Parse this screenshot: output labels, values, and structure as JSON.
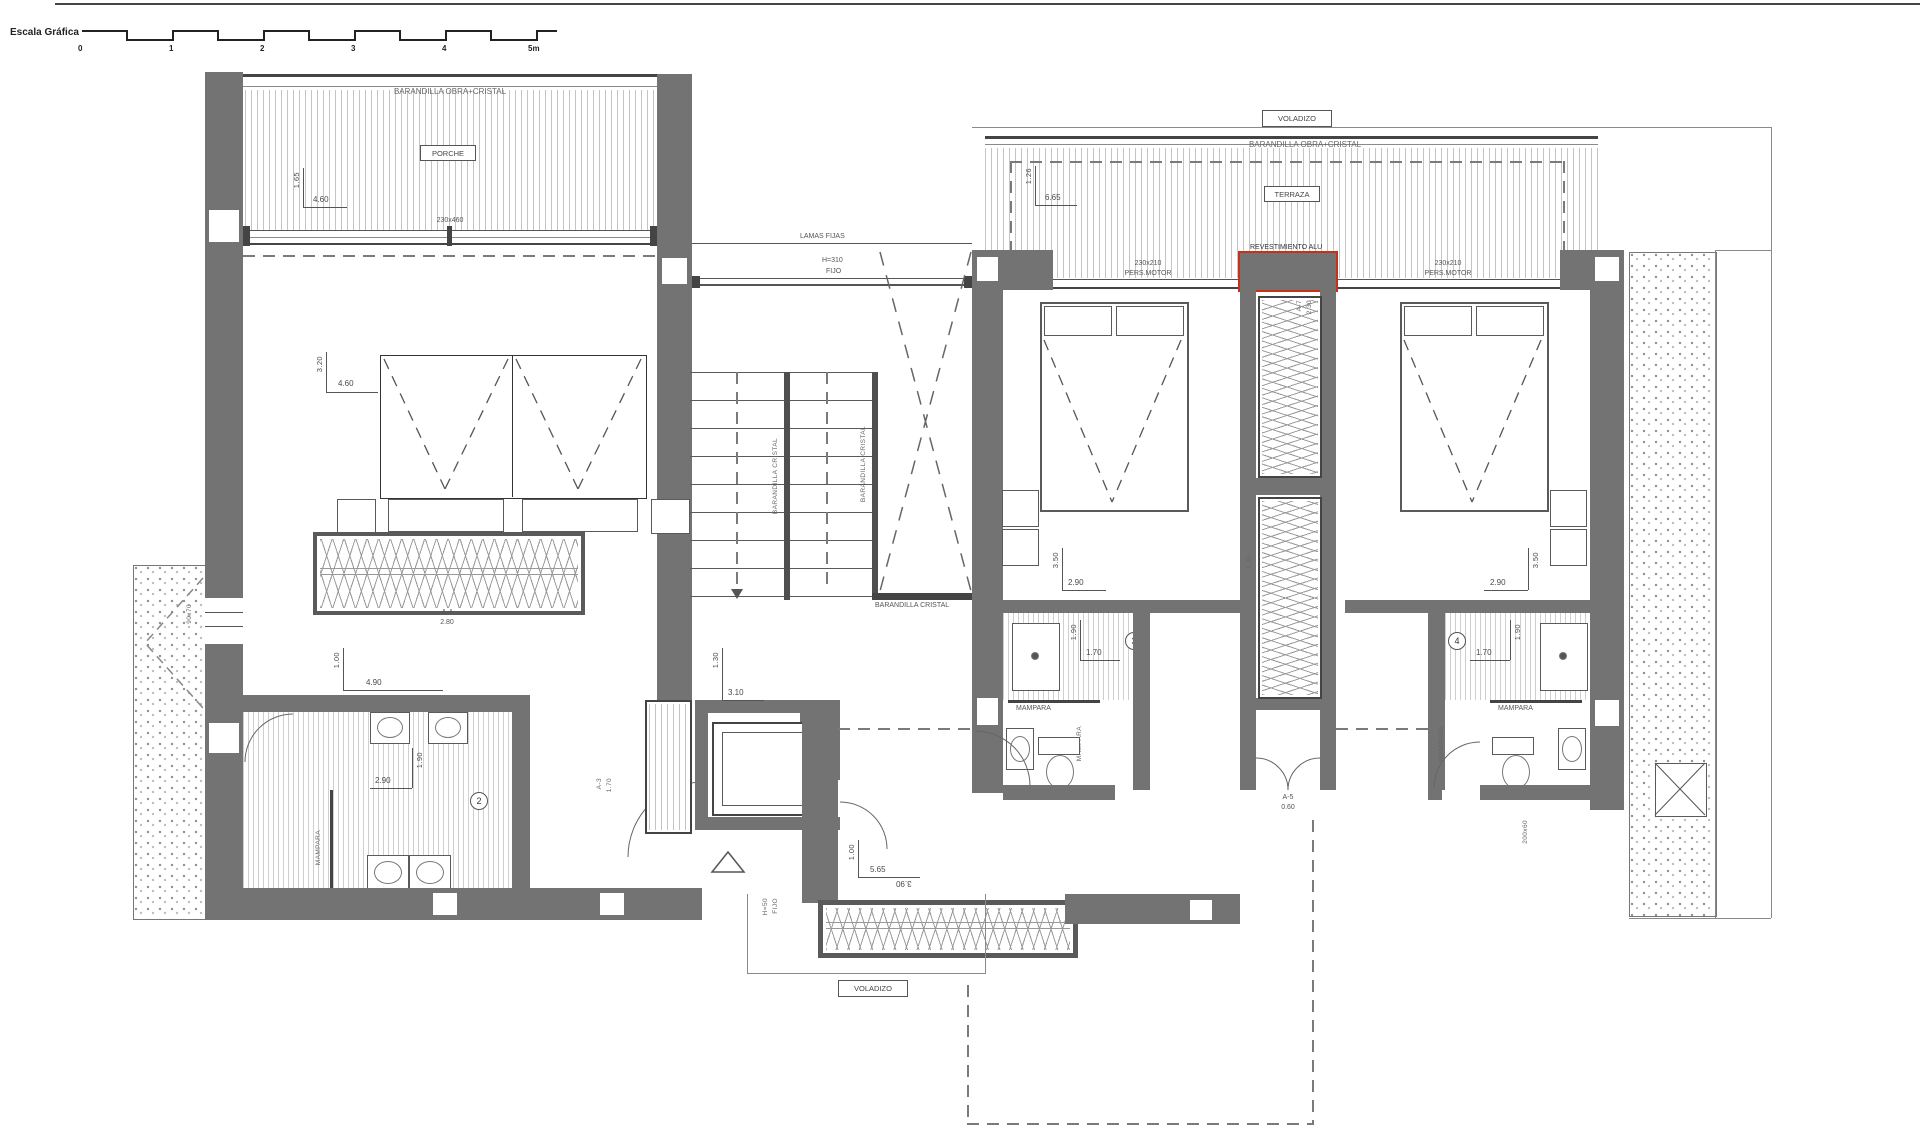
{
  "drawing": {
    "scale_bar": {
      "title": "Escala Gráfica",
      "ticks": [
        "0",
        "1",
        "2",
        "3",
        "4",
        "5m"
      ]
    },
    "porch": {
      "railing": "BARANDILLA OBRA+CRISTAL",
      "name": "PORCHE",
      "dim_v": "1.65",
      "dim_h": "4.60",
      "window": "230x460"
    },
    "louvres": {
      "label": "LAMAS FIJAS",
      "win_l1": "H=310",
      "win_l2": "FIJO"
    },
    "terrace": {
      "voladizo": "VOLADIZO",
      "railing": "BARANDILLA OBRA+CRISTAL",
      "name": "TERRAZA",
      "dim_v": "1.26",
      "dim_h": "6.65",
      "shutter3_l1": "230x210",
      "shutter3_l2": "PERS.MOTOR",
      "cladding": "REVESTIMIENTO ALU",
      "shutter4_l1": "230x210",
      "shutter4_l2": "PERS.MOTOR"
    },
    "master": {
      "dim_v": "3.20",
      "dim_h": "4.60",
      "win_l1": "A-4",
      "win_l2": "2.80",
      "dim2_v": "1.00",
      "dim2_h": "4.90"
    },
    "stairs": {
      "rail1": "BARANDILLA CRISTAL",
      "rail2": "BARANDILLA CRISTAL",
      "rail3": "BARANDILLA CRISTAL"
    },
    "bath2": {
      "num": "2",
      "dim_v": "1.90",
      "dim_h": "2.90",
      "screen": "MAMPARA",
      "window": "90x70"
    },
    "lift": {
      "win_l1": "A-3",
      "win_l2": "1.70",
      "dim_v": "1.30",
      "dim_h": "3.10"
    },
    "bed3": {
      "dim_v": "3.50",
      "dim_h": "2.90"
    },
    "bath3": {
      "num": "3",
      "dim_v": "1.90",
      "dim_h": "1.70",
      "screen_top": "MAMPARA",
      "screen_side": "MAMPARA"
    },
    "shaft": {
      "win1_l1": "A-7",
      "win1_l2": "2.30",
      "win2": "2.30",
      "door_l1": "A-5",
      "door_l2": "0.60"
    },
    "bed4": {
      "dim_v": "3.50",
      "dim_h": "2.90"
    },
    "bath4": {
      "num": "4",
      "dim_v": "1.90",
      "dim_h": "1.70",
      "screen_top": "MAMPARA",
      "screen_side": "MAMPARA"
    },
    "entry": {
      "dim_v": "1.00",
      "dim_h": "5.65",
      "dim_flip": "3.90",
      "win_l1": "H=50",
      "win_l2": "FIJO",
      "voladizo": "VOLADIZO"
    },
    "east": {
      "window": "200x60"
    },
    "colors": {
      "wall": "#737373",
      "accent_red": "#c83118"
    }
  }
}
